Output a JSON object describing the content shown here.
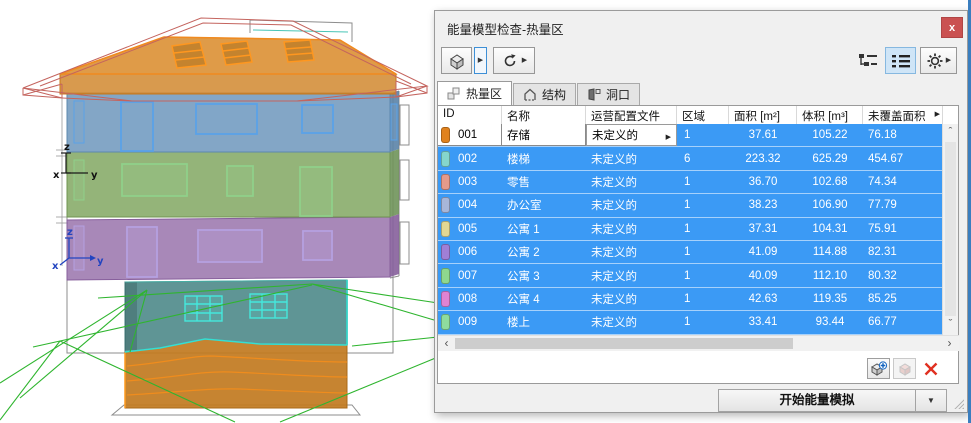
{
  "window": {
    "title": "能量模型检查-热量区"
  },
  "icons": {
    "close": "x",
    "flyout": "▶",
    "dropdown": "▼",
    "more_columns": "▶",
    "scroll_up": "ˆ",
    "scroll_down": "ˇ",
    "scroll_left": "‹",
    "scroll_right": "›"
  },
  "tabs": [
    {
      "label": "热量区",
      "active": true
    },
    {
      "label": "结构",
      "active": false
    },
    {
      "label": "洞口",
      "active": false
    }
  ],
  "table": {
    "columns": [
      "ID",
      "名称",
      "运营配置文件",
      "区域",
      "面积 [m²]",
      "体积 [m³]",
      "未覆盖面积"
    ],
    "rows": [
      {
        "id": "001",
        "name": "存储",
        "profile": "未定义的",
        "zones": "1",
        "area": "37.61",
        "volume": "105.22",
        "uncovered": "76.18",
        "color": "#e0821e"
      },
      {
        "id": "002",
        "name": "楼梯",
        "profile": "未定义的",
        "zones": "6",
        "area": "223.32",
        "volume": "625.29",
        "uncovered": "454.67",
        "color": "#85d6cc"
      },
      {
        "id": "003",
        "name": "零售",
        "profile": "未定义的",
        "zones": "1",
        "area": "36.70",
        "volume": "102.68",
        "uncovered": "74.34",
        "color": "#e49a8a"
      },
      {
        "id": "004",
        "name": "办公室",
        "profile": "未定义的",
        "zones": "1",
        "area": "38.23",
        "volume": "106.90",
        "uncovered": "77.79",
        "color": "#a7b6d9"
      },
      {
        "id": "005",
        "name": "公寓 1",
        "profile": "未定义的",
        "zones": "1",
        "area": "37.31",
        "volume": "104.31",
        "uncovered": "75.91",
        "color": "#e2d794"
      },
      {
        "id": "006",
        "name": "公寓 2",
        "profile": "未定义的",
        "zones": "1",
        "area": "41.09",
        "volume": "114.88",
        "uncovered": "82.31",
        "color": "#a07fd6"
      },
      {
        "id": "007",
        "name": "公寓 3",
        "profile": "未定义的",
        "zones": "1",
        "area": "40.09",
        "volume": "112.10",
        "uncovered": "80.32",
        "color": "#8ed88e"
      },
      {
        "id": "008",
        "name": "公寓 4",
        "profile": "未定义的",
        "zones": "1",
        "area": "42.63",
        "volume": "119.35",
        "uncovered": "85.25",
        "color": "#df83d3"
      },
      {
        "id": "009",
        "name": "楼上",
        "profile": "未定义的",
        "zones": "1",
        "area": "33.41",
        "volume": "93.44",
        "uncovered": "66.77",
        "color": "#8edc9e"
      }
    ],
    "selection_color": "#3b9af5"
  },
  "footer": {
    "start_label": "开始能量模拟"
  },
  "model": {
    "axis": {
      "x": "x",
      "y": "y",
      "z": "z"
    },
    "zone_colors": {
      "roof": "#d98a28",
      "floor3": "#6d97bc",
      "floor2": "#81a762",
      "floor1": "#9973ac",
      "ground": "#4e8a8a",
      "basement": "#c17a1f",
      "terrain_lines": "#2fb52f",
      "roof_wireframe": "#c4645e"
    }
  }
}
